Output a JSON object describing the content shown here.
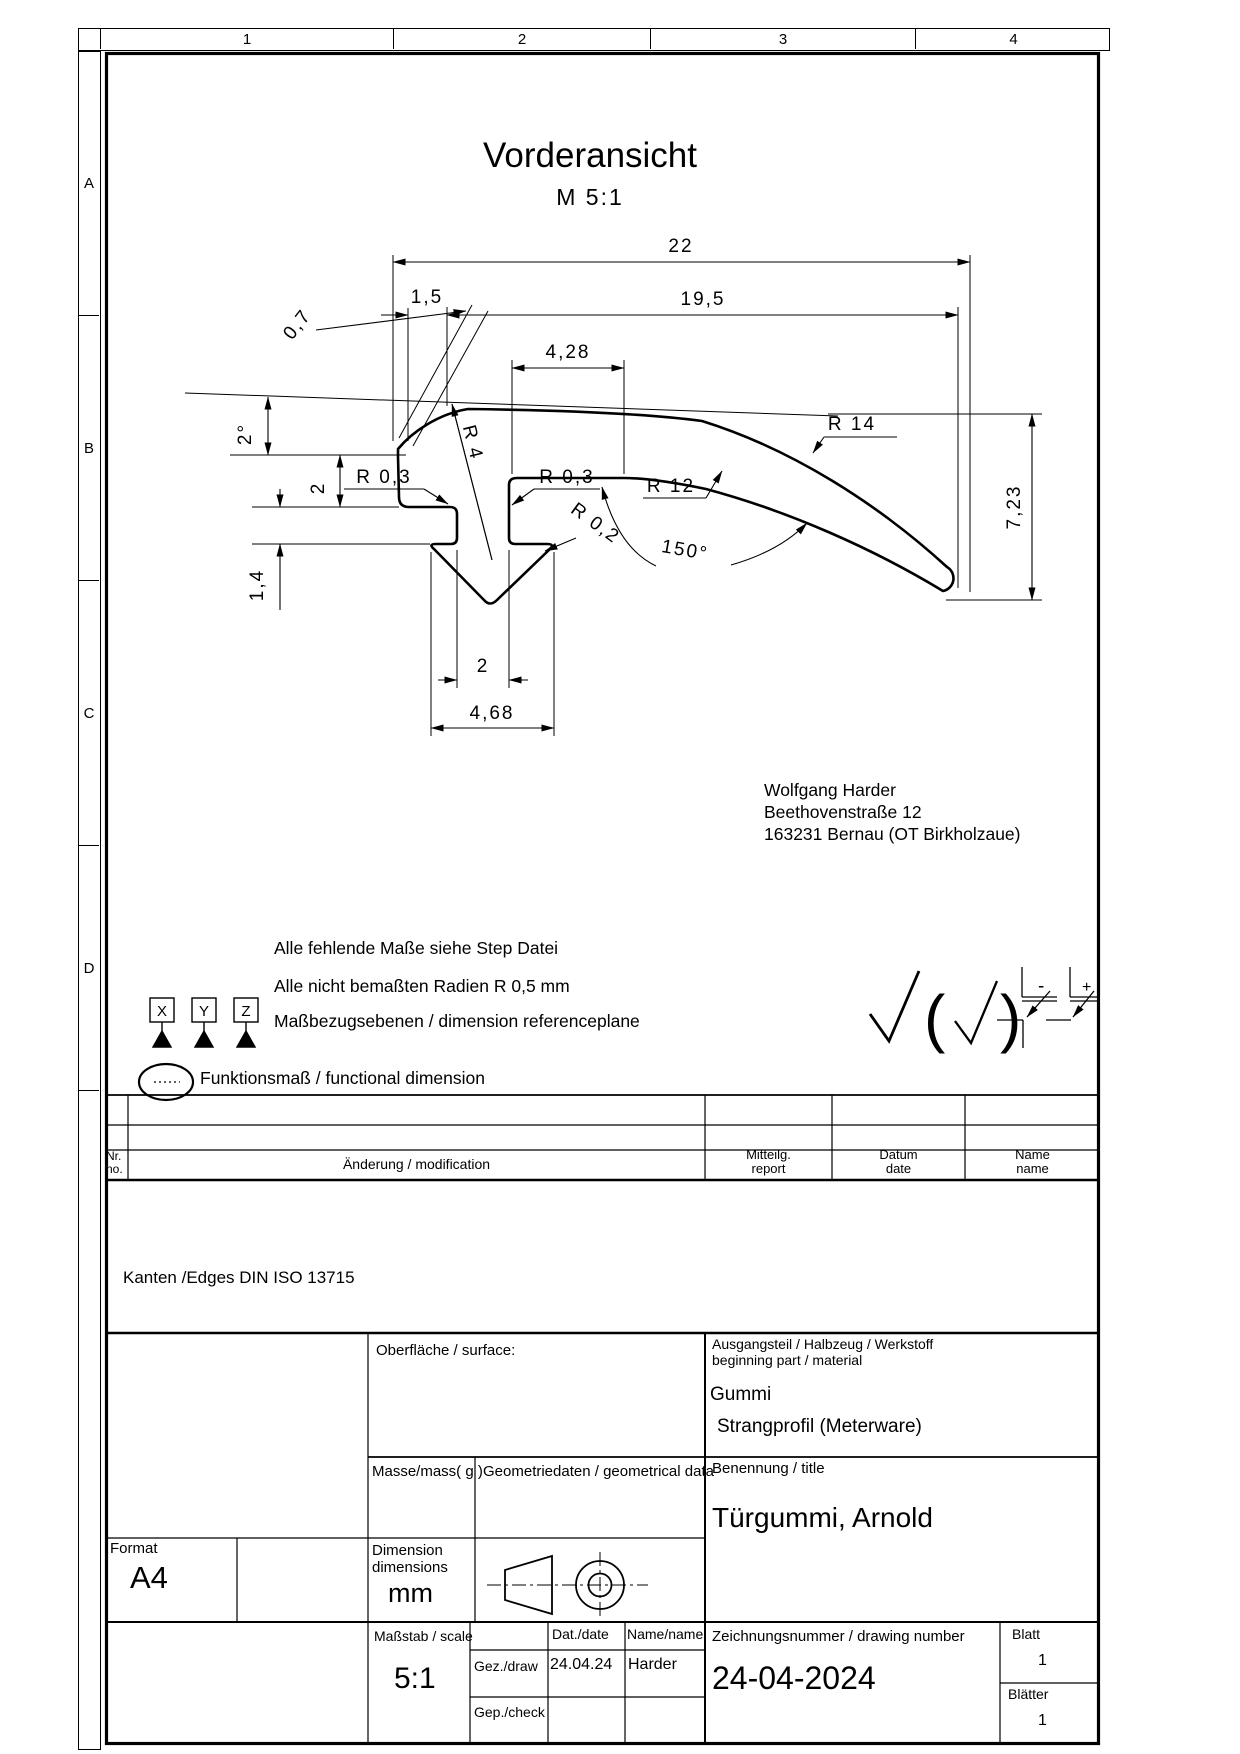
{
  "view": {
    "title": "Vorderansicht",
    "scale": "M  5:1"
  },
  "grid": {
    "cols": [
      "1",
      "2",
      "3",
      "4"
    ],
    "rows": [
      "A",
      "B",
      "C",
      "D"
    ]
  },
  "dims": {
    "w22": "22",
    "w195": "19,5",
    "w15": "1,5",
    "w428": "4,28",
    "t07": "0,7",
    "ang2": "2°",
    "h2": "2",
    "h14": "1,4",
    "r03_left": "R 0,3",
    "r03_right": "R 0,3",
    "r4": "R 4",
    "r12": "R 12",
    "r14": "R 14",
    "r02": "R 0,2",
    "ang150": "150°",
    "h723": "7,23",
    "w2": "2",
    "w468": "4,68"
  },
  "notes": {
    "line1": "Alle fehlende Maße siehe Step Datei",
    "line2": "Alle nicht bemaßten Radien R 0,5 mm",
    "line3": "Maßbezugsebenen / dimension referenceplane",
    "line4": "Funktionsmaß / functional dimension",
    "kanten": "Kanten /Edges DIN ISO 13715",
    "datums": [
      "X",
      "Y",
      "Z"
    ]
  },
  "address": {
    "name": "Wolfgang Harder",
    "street": "Beethovenstraße 12",
    "city": "163231 Bernau (OT Birkholzaue)"
  },
  "edge_symbols": {
    "minus": "-",
    "plus": "+"
  },
  "revision_table": {
    "nr": "Nr.",
    "no": "no.",
    "change": "Änderung / modification",
    "mitteilg": "Mitteilg.",
    "report": "report",
    "datum": "Datum",
    "date": "date",
    "name": "Name",
    "name_en": "name"
  },
  "title_block": {
    "surface_label": "Oberfläche / surface:",
    "mass_label": "Masse/mass( g )",
    "geometry_label": "Geometriedaten / geometrical data",
    "format_label": "Format",
    "format_value": "A4",
    "dimension_label_1": "Dimension",
    "dimension_label_2": "dimensions",
    "dimension_unit": "mm",
    "material_label_de": "Ausgangsteil / Halbzeug / Werkstoff",
    "material_label_en": "beginning part / material",
    "material_value_1": "Gummi",
    "material_value_2": "Strangprofil (Meterware)",
    "title_label": "Benennung / title",
    "title_value": "Türgummi, Arnold",
    "scale_label": "Maßstab / scale",
    "scale_value": "5:1",
    "date_label": "Dat./date",
    "name_label": "Name/name",
    "drawn_label": "Gez./draw",
    "drawn_date": "24.04.24",
    "drawn_name": "Harder",
    "checked_label": "Gep./check",
    "drawing_number_label": "Zeichnungsnummer / drawing number",
    "drawing_number": "24-04-2024",
    "sheet_label": "Blatt",
    "sheet_value": "1",
    "sheets_label": "Blätter",
    "sheets_value": "1"
  }
}
